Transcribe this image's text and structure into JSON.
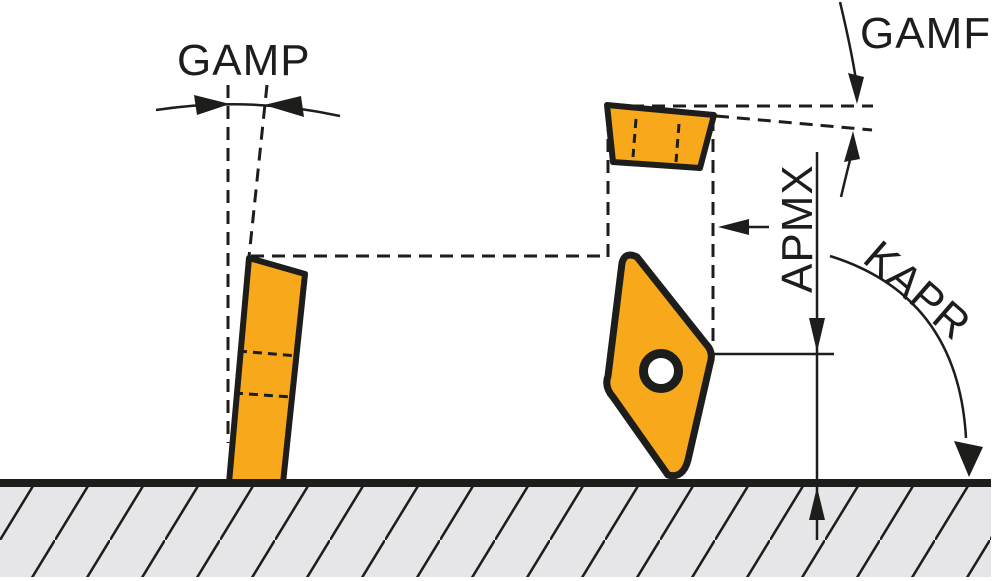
{
  "diagram": {
    "labels": {
      "gamp": "GAMP",
      "gamf": "GAMF",
      "apmx": "APMX",
      "kapr": "KAPR"
    },
    "colors": {
      "insert": "#F7A81B",
      "outline": "#1D1D1B",
      "workpiece": "#E6E6E8",
      "background": "#FFFFFF"
    }
  }
}
